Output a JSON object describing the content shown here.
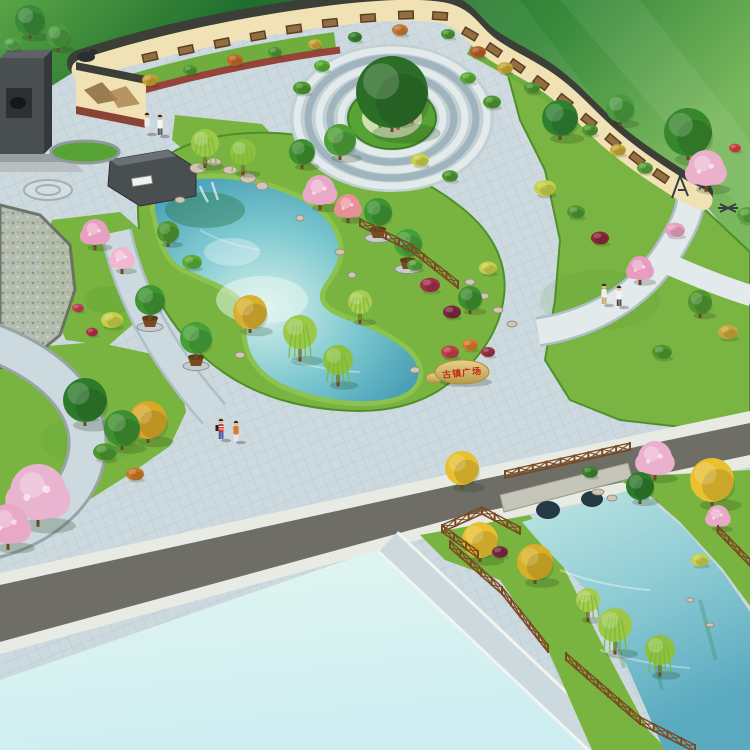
{
  "scene": {
    "kind": "aerial-landscape-architecture-rendering",
    "features": [
      "mural-wall",
      "central-circle-plaza",
      "pond-garden",
      "inscription-stone",
      "stone-bridge-canal",
      "empty-parcel",
      "roads",
      "pedestrians"
    ]
  },
  "inscription": {
    "text": "古镇广场"
  },
  "palette": {
    "field1": "#5aa546",
    "field2": "#1f6e2e",
    "field3": "#7ab85e",
    "lawn": "#79b440",
    "lawnEdge": "#4e8f28",
    "hedge": "#57a336",
    "paving": "#ccd9df",
    "pavLine": "#aebfc7",
    "pavDark": "#9fb4bc",
    "pavLight": "#e3eaec",
    "water1": "#d8f0ea",
    "water2": "#7cc8d0",
    "water3": "#2e8aa8",
    "wallCream": "#f0e2b4",
    "wallCoping": "#3b3f37",
    "mural1": "#5f3f22",
    "mural2": "#9a7848",
    "road": "#6e6d66",
    "sidewalk": "#e8ebe4",
    "parcel1": "#e2f6ef",
    "parcel2": "#cfeef2",
    "wood": "#7a4a22",
    "stone1": "#e8d28a",
    "stone2": "#b89848",
    "red": "#c42818",
    "trunk": "#6b4a26",
    "rock": "#cfc7b4",
    "rockLine": "#8f8776",
    "monA": "#494e51",
    "monB": "#5d6366",
    "monC": "#34383a",
    "pathRed": "#96443a",
    "skin": "#e8bc90"
  },
  "trees": [
    [
      30,
      20,
      15,
      "#3a8a38",
      "t"
    ],
    [
      58,
      36,
      12,
      "#4a9a40",
      "t"
    ],
    [
      12,
      44,
      9,
      "#55a348",
      "s"
    ],
    [
      150,
      80,
      8,
      "#c8a030",
      "s"
    ],
    [
      190,
      70,
      7,
      "#4e9630",
      "s"
    ],
    [
      235,
      60,
      8,
      "#c06a28",
      "s"
    ],
    [
      275,
      52,
      7,
      "#4e9630",
      "s"
    ],
    [
      315,
      44,
      7,
      "#c8a838",
      "s"
    ],
    [
      355,
      37,
      7,
      "#38842e",
      "s"
    ],
    [
      400,
      30,
      8,
      "#c87830",
      "s"
    ],
    [
      448,
      34,
      7,
      "#4e9630",
      "s"
    ],
    [
      478,
      52,
      8,
      "#b85a28",
      "s"
    ],
    [
      505,
      68,
      8,
      "#c8a838",
      "s"
    ],
    [
      532,
      88,
      8,
      "#4e9630",
      "s"
    ],
    [
      560,
      108,
      8,
      "#c06a28",
      "s"
    ],
    [
      590,
      130,
      8,
      "#4e9630",
      "s"
    ],
    [
      618,
      150,
      8,
      "#c8a838",
      "s"
    ],
    [
      645,
      168,
      8,
      "#58a038",
      "s"
    ],
    [
      392,
      92,
      36,
      "#2c6e28",
      "t"
    ],
    [
      302,
      88,
      9,
      "#4e9630",
      "s"
    ],
    [
      322,
      66,
      8,
      "#58ab34",
      "s"
    ],
    [
      468,
      78,
      8,
      "#58ab34",
      "s"
    ],
    [
      492,
      102,
      9,
      "#4e9630",
      "s"
    ],
    [
      420,
      160,
      9,
      "#c8d048",
      "s"
    ],
    [
      450,
      176,
      8,
      "#4e9630",
      "s"
    ],
    [
      340,
      140,
      16,
      "#4f9f38",
      "t"
    ],
    [
      302,
      152,
      13,
      "#3e8f30",
      "t"
    ],
    [
      320,
      190,
      15,
      "#e8a8c8",
      "b"
    ],
    [
      348,
      206,
      12,
      "#e89098",
      "b"
    ],
    [
      205,
      143,
      14,
      "#9cc848",
      "w"
    ],
    [
      243,
      152,
      13,
      "#8cc03e",
      "w"
    ],
    [
      378,
      212,
      14,
      "#3f9434",
      "p"
    ],
    [
      408,
      243,
      14,
      "#46a038",
      "p"
    ],
    [
      150,
      300,
      15,
      "#3f9434",
      "p"
    ],
    [
      196,
      338,
      16,
      "#46a038",
      "p"
    ],
    [
      430,
      285,
      10,
      "#a03048",
      "s"
    ],
    [
      452,
      312,
      9,
      "#7a2840",
      "s"
    ],
    [
      470,
      298,
      12,
      "#3e8f30",
      "t"
    ],
    [
      488,
      268,
      9,
      "#c8d048",
      "s"
    ],
    [
      415,
      265,
      8,
      "#58a038",
      "s"
    ],
    [
      300,
      332,
      17,
      "#9cc848",
      "w"
    ],
    [
      338,
      360,
      15,
      "#8cc03e",
      "w"
    ],
    [
      360,
      302,
      12,
      "#a8cc50",
      "w"
    ],
    [
      250,
      312,
      17,
      "#d8b030",
      "t"
    ],
    [
      168,
      232,
      11,
      "#4e9630",
      "t"
    ],
    [
      192,
      262,
      10,
      "#58ab34",
      "s"
    ],
    [
      95,
      232,
      13,
      "#e8a0c0",
      "b"
    ],
    [
      122,
      258,
      11,
      "#f0b8d0",
      "b"
    ],
    [
      112,
      320,
      11,
      "#c8d048",
      "s"
    ],
    [
      78,
      308,
      6,
      "#c04058",
      "s"
    ],
    [
      92,
      332,
      6,
      "#b03048",
      "s"
    ],
    [
      85,
      400,
      22,
      "#2e7a2a",
      "t"
    ],
    [
      122,
      428,
      18,
      "#3e8f30",
      "t"
    ],
    [
      148,
      420,
      19,
      "#d8a828",
      "t"
    ],
    [
      135,
      474,
      9,
      "#c87828",
      "s"
    ],
    [
      38,
      492,
      28,
      "#e8b4d0",
      "b"
    ],
    [
      8,
      524,
      20,
      "#e8a8c8",
      "b"
    ],
    [
      105,
      452,
      12,
      "#4e9630",
      "s"
    ],
    [
      560,
      118,
      18,
      "#2f8030",
      "t"
    ],
    [
      688,
      132,
      24,
      "#37872d",
      "t"
    ],
    [
      620,
      108,
      14,
      "#4a9a40",
      "t"
    ],
    [
      706,
      168,
      18,
      "#eab0cc",
      "b"
    ],
    [
      675,
      230,
      10,
      "#e8a0c0",
      "s"
    ],
    [
      545,
      188,
      11,
      "#c8d048",
      "s"
    ],
    [
      576,
      212,
      9,
      "#4e9630",
      "s"
    ],
    [
      640,
      268,
      12,
      "#e89cc0",
      "b"
    ],
    [
      700,
      302,
      12,
      "#4e9630",
      "t"
    ],
    [
      728,
      332,
      10,
      "#c8a838",
      "s"
    ],
    [
      748,
      215,
      11,
      "#58a038",
      "s"
    ],
    [
      735,
      148,
      6,
      "#d04040",
      "s"
    ],
    [
      600,
      238,
      9,
      "#8a2838",
      "s"
    ],
    [
      662,
      352,
      10,
      "#4e9630",
      "s"
    ],
    [
      450,
      352,
      9,
      "#c04048",
      "s"
    ],
    [
      470,
      345,
      8,
      "#d87828",
      "s"
    ],
    [
      488,
      352,
      7,
      "#a03048",
      "s"
    ],
    [
      462,
      468,
      17,
      "#e8c030",
      "t"
    ],
    [
      480,
      540,
      18,
      "#e8c030",
      "t"
    ],
    [
      535,
      562,
      18,
      "#d8b028",
      "t"
    ],
    [
      655,
      458,
      17,
      "#eab0cc",
      "b"
    ],
    [
      712,
      480,
      22,
      "#e8c030",
      "t"
    ],
    [
      718,
      516,
      11,
      "#e8a8c8",
      "b"
    ],
    [
      640,
      486,
      14,
      "#2e7a2a",
      "t"
    ],
    [
      615,
      625,
      17,
      "#9cc848",
      "w"
    ],
    [
      660,
      650,
      15,
      "#8cc03e",
      "w"
    ],
    [
      588,
      600,
      12,
      "#a8cc50",
      "w"
    ],
    [
      700,
      560,
      9,
      "#c8d048",
      "s"
    ],
    [
      590,
      472,
      8,
      "#38842e",
      "s"
    ],
    [
      500,
      552,
      8,
      "#7a2840",
      "s"
    ]
  ],
  "rocks": [
    [
      198,
      168,
      8,
      5
    ],
    [
      214,
      162,
      7,
      4
    ],
    [
      230,
      170,
      7,
      4
    ],
    [
      248,
      178,
      8,
      5
    ],
    [
      262,
      186,
      6,
      4
    ],
    [
      180,
      200,
      5,
      3
    ],
    [
      340,
      252,
      5,
      3
    ],
    [
      300,
      218,
      4,
      3
    ],
    [
      352,
      275,
      4,
      3
    ],
    [
      240,
      355,
      5,
      3
    ],
    [
      415,
      370,
      5,
      3
    ],
    [
      470,
      282,
      5,
      3
    ],
    [
      484,
      296,
      5,
      3
    ],
    [
      498,
      310,
      5,
      3
    ],
    [
      512,
      324,
      5,
      3
    ],
    [
      598,
      492,
      6,
      3
    ],
    [
      612,
      498,
      5,
      3
    ],
    [
      690,
      600,
      4,
      2
    ],
    [
      710,
      625,
      4,
      2
    ]
  ],
  "fences": [
    [
      360,
      226,
      412,
      252
    ],
    [
      412,
      252,
      458,
      288
    ],
    [
      505,
      478,
      630,
      450
    ],
    [
      450,
      548,
      502,
      594
    ],
    [
      502,
      594,
      548,
      652
    ],
    [
      566,
      660,
      640,
      724
    ],
    [
      640,
      724,
      695,
      752
    ],
    [
      442,
      532,
      482,
      514
    ],
    [
      482,
      514,
      520,
      534
    ],
    [
      442,
      532,
      478,
      558
    ],
    [
      718,
      533,
      750,
      566
    ]
  ],
  "murals": [
    [
      150,
      57,
      -13
    ],
    [
      186,
      50,
      -12
    ],
    [
      222,
      43,
      -11
    ],
    [
      258,
      36,
      -10
    ],
    [
      294,
      29,
      -8
    ],
    [
      330,
      23,
      -6
    ],
    [
      368,
      18,
      -4
    ],
    [
      406,
      15,
      -2
    ],
    [
      440,
      16,
      4
    ],
    [
      470,
      34,
      30
    ],
    [
      494,
      50,
      34
    ],
    [
      517,
      66,
      35
    ],
    [
      541,
      83,
      37
    ],
    [
      565,
      101,
      38
    ],
    [
      589,
      121,
      39
    ],
    [
      613,
      141,
      40
    ],
    [
      637,
      159,
      38
    ],
    [
      661,
      176,
      34
    ]
  ],
  "people": [
    [
      221,
      424,
      "#cc3a3a",
      "#3a5aa8",
      1
    ],
    [
      236,
      426,
      "#e07830",
      "#ececec",
      0
    ],
    [
      604,
      289,
      "#efefef",
      "#c8a870",
      0
    ],
    [
      619,
      291,
      "#f4f4f4",
      "#4a4a4a",
      0
    ],
    [
      147,
      118,
      "#ededed",
      "#dcdcdc",
      0
    ],
    [
      160,
      120,
      "#f6f6f6",
      "#555555",
      0
    ]
  ]
}
